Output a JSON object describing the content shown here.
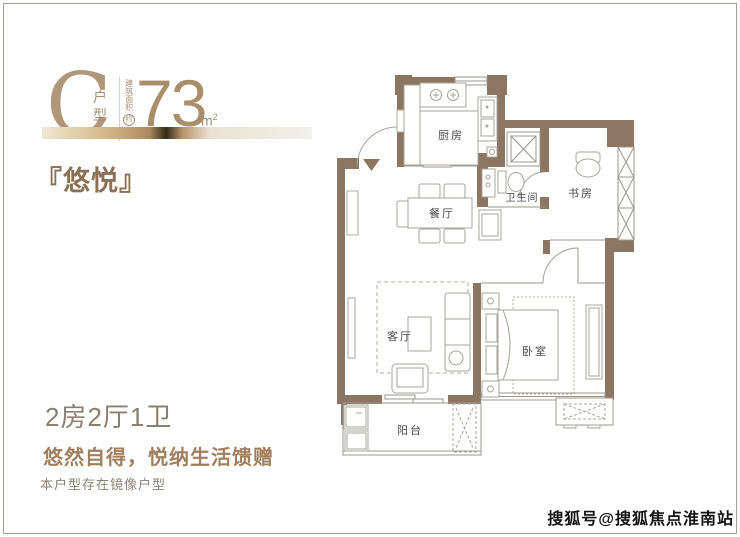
{
  "header": {
    "unit_letter": "C",
    "unit_suffix_1": "户",
    "unit_suffix_2": "型",
    "area_prefix_vertical": "建筑面积",
    "area_circled": "约",
    "area_value": "73",
    "area_unit": "m",
    "area_unit_sup": "2",
    "project_name": "『悠悦』"
  },
  "plan": {
    "rooms": [
      {
        "id": "kitchen",
        "label": "厨房"
      },
      {
        "id": "dining",
        "label": "餐厅"
      },
      {
        "id": "bath",
        "label": "卫生间"
      },
      {
        "id": "study",
        "label": "书房"
      },
      {
        "id": "living",
        "label": "客厅"
      },
      {
        "id": "bedroom",
        "label": "卧室"
      },
      {
        "id": "balcony",
        "label": "阳台"
      }
    ]
  },
  "footer": {
    "layout": "2房2厅1卫",
    "slogan": "悠然自得，悦纳生活馈赠",
    "note": "本户型存在镜像户型"
  },
  "watermark": "搜狐号@搜狐焦点淮南站",
  "colors": {
    "wall": "#8c7561",
    "bronze_title": "#b1977a",
    "bronze_value": "#a98e6c",
    "name_brown": "#8a7054",
    "slogan_brown": "#a17f5e",
    "layout_gray": "#8b7f71"
  }
}
